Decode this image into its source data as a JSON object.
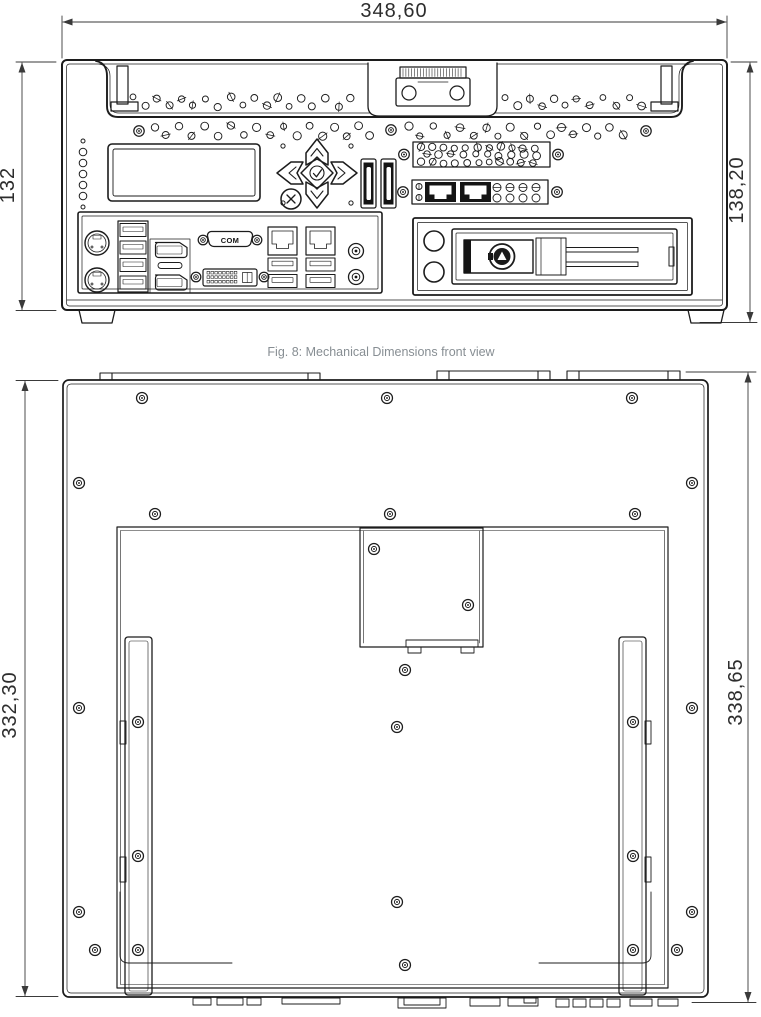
{
  "figure": {
    "caption": "Fig. 8: Mechanical Dimensions front view"
  },
  "front_view": {
    "dim_width_top": "348,60",
    "dim_height_left": "132",
    "dim_height_right": "138,20",
    "com_port_label": "COM"
  },
  "back_view": {
    "dim_height_left": "332,30",
    "dim_height_right": "338,65"
  },
  "colors": {
    "line": "#1c1c1c",
    "dim_text": "#2d2d2d",
    "caption_text": "#878e93",
    "background": "#ffffff"
  }
}
